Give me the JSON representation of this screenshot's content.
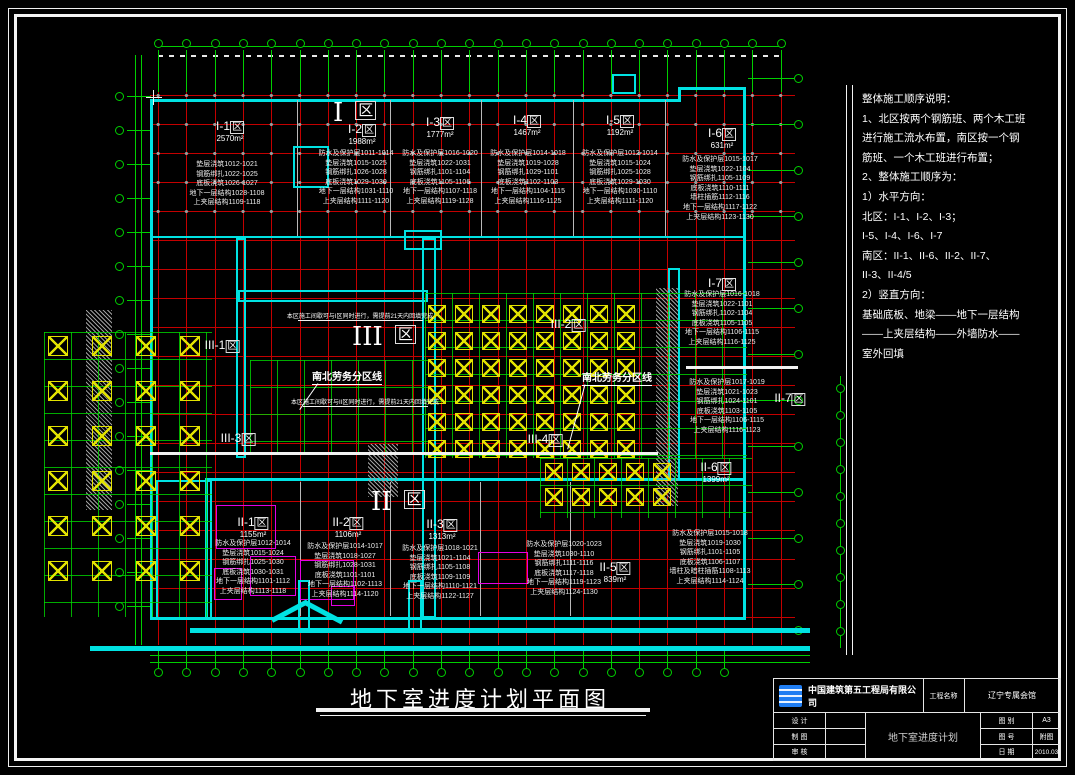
{
  "title": {
    "text": "地下室进度计划平面图"
  },
  "notes": {
    "lines": [
      "整体施工顺序说明：",
      "1、北区按两个钢筋班、两个木工班",
      "进行施工流水布置，南区按一个钢",
      "筋班、一个木工班进行布置；",
      "2、整体施工顺序为：",
      "1）水平方向：",
      "北区：I-1、I-2、I-3；",
      "I-5、I-4、I-6、I-7",
      "南区：II-1、II-6、II-2、II-7、",
      "II-3、II-4/5",
      "2）竖直方向：",
      "基础底板、地梁——地下一层结构",
      "——上夹层结构——外墙防水——",
      "室外回填"
    ]
  },
  "plan": {
    "big_labels": [
      {
        "id": "I",
        "text": "I",
        "qu": "区"
      },
      {
        "id": "III",
        "text": "III",
        "qu": "区"
      },
      {
        "id": "II",
        "text": "II",
        "qu": "区"
      }
    ],
    "zones": [
      {
        "id": "I-1",
        "label": "I-1区",
        "area": "2570m²",
        "tasks": [
          "垫层浇筑1012-1021",
          "钢筋绑扎1022-1025",
          "底板浇筑1026-1027",
          "地下一层结构1028-1108",
          "上夹层结构1109-1118"
        ]
      },
      {
        "id": "I-2",
        "label": "I-2区",
        "area": "1988m²",
        "tasks": [
          "防水及保护层1011-1014",
          "垫层浇筑1015-1025",
          "钢筋绑扎1026-1028",
          "底板浇筑1029-1030",
          "地下一层结构1031-1110",
          "上夹层结构1111-1120"
        ]
      },
      {
        "id": "I-3",
        "label": "I-3区",
        "area": "1777m²",
        "tasks": [
          "防水及保护层1016-1020",
          "垫层浇筑1022-1031",
          "钢筋绑扎1101-1104",
          "底板浇筑1105-1106",
          "地下一层结构1107-1118",
          "上夹层结构1119-1128"
        ]
      },
      {
        "id": "I-4",
        "label": "I-4区",
        "area": "1467m²",
        "tasks": [
          "防水及保护层1014-1018",
          "垫层浇筑1019-1028",
          "钢筋绑扎1029-1101",
          "底板浇筑1102-1103",
          "地下一层结构1104-1115",
          "上夹层结构1116-1125"
        ]
      },
      {
        "id": "I-5",
        "label": "I-5区",
        "area": "1192m²",
        "tasks": [
          "防水及保护层1012-1014",
          "垫层浇筑1015-1024",
          "钢筋绑扎1025-1028",
          "底板浇筑1029-1030",
          "地下一层结构1030-1110",
          "上夹层结构1111-1120"
        ]
      },
      {
        "id": "I-6",
        "label": "I-6区",
        "area": "631m²",
        "tasks": [
          "防水及保护层1015-1017",
          "垫层浇筑1022-1104",
          "钢筋绑扎1105-1109",
          "底板浇筑1110-1111",
          "墙柱插筋1112-1116",
          "地下一层结构1117-1122",
          "上夹层结构1123-1130"
        ]
      },
      {
        "id": "I-7",
        "label": "I-7区",
        "area": "",
        "tasks": [
          "防水及保护层1016-1018",
          "垫层浇筑1022-1101",
          "钢筋绑扎1102-1104",
          "底板浇筑1105-1105",
          "地下一层结构1106-1115",
          "上夹层结构1116-1125"
        ]
      },
      {
        "id": "II-7",
        "label": "II-7区",
        "area": "",
        "tasks": [
          "防水及保护层1017-1019",
          "垫层浇筑1021-1023",
          "钢筋绑扎1024-1101",
          "底板浇筑1103-1105",
          "地下一层结构1106-1115",
          "上夹层结构1116-1123"
        ]
      },
      {
        "id": "II-1",
        "label": "II-1区",
        "area": "1155m²",
        "tasks": [
          "防水及保护层1012-1014",
          "垫层浇筑1015-1024",
          "钢筋绑扎1025-1030",
          "底板浇筑1030-1031",
          "地下一层结构1101-1112",
          "上夹层结构1113-1118"
        ]
      },
      {
        "id": "II-2",
        "label": "II-2区",
        "area": "1106m²",
        "tasks": [
          "防水及保护层1014-1017",
          "垫层浇筑1018-1027",
          "钢筋绑扎1028-1031",
          "底板浇筑1101-1101",
          "地下一层结构1102-1113",
          "上夹层结构1114-1120"
        ]
      },
      {
        "id": "II-3",
        "label": "II-3区",
        "area": "1313m²",
        "tasks": [
          "防水及保护层1018-1021",
          "垫层浇筑1021-1104",
          "钢筋绑扎1105-1108",
          "底板浇筑1109-1109",
          "地下一层结构1110-1121",
          "上夹层结构1122-1127"
        ]
      },
      {
        "id": "II-5",
        "label": "II-5区",
        "area": "839m²",
        "tasks": [
          "防水及保护层1020-1023",
          "垫层浇筑1030-1110",
          "钢筋绑扎1111-1116",
          "底板浇筑1117-1118",
          "地下一层结构1119-1123",
          "上夹层结构1124-1130"
        ]
      },
      {
        "id": "II-6",
        "label": "II-6区",
        "area": "1399m²",
        "tasks": [
          "防水及保护层1015-1018",
          "垫层浇筑1019-1030",
          "钢筋绑扎1101-1105",
          "底板浇筑1106-1107",
          "墙柱及暗柱插筋1108-1113",
          "上夹层结构1114-1124"
        ]
      },
      {
        "id": "III-1",
        "label": "III-1区",
        "area": "",
        "tasks": []
      },
      {
        "id": "III-2",
        "label": "III-2区",
        "area": "",
        "tasks": []
      },
      {
        "id": "III-3",
        "label": "III-3区",
        "area": "",
        "tasks": []
      },
      {
        "id": "III-4",
        "label": "III-4区",
        "area": "",
        "tasks": []
      }
    ],
    "dividers": [
      {
        "text": "南北劳务分区线"
      },
      {
        "text": "南北劳务分区线"
      }
    ],
    "annotations": [
      {
        "text": "本区施工间歇可与I区同时进行，需提前21天内回填完成"
      },
      {
        "text": "本区施工间歇可与II区同时进行，需提前21天内回填完成"
      }
    ]
  },
  "titleblock": {
    "company": "中国建筑第五工程局有限公司",
    "project_label": "工程名称",
    "project_name": "辽宁专属会馆",
    "drawing_name": "地下室进度计划",
    "rows_left": [
      {
        "label": "设  计"
      },
      {
        "label": "制  图"
      },
      {
        "label": "审  核"
      }
    ],
    "rows_right": [
      {
        "label": "图  别",
        "value": "A3"
      },
      {
        "label": "图  号",
        "value": "附图"
      },
      {
        "label": "日  期",
        "value": "2010.03"
      }
    ]
  },
  "colors": {
    "grid_red": "#c40000",
    "axis_green": "#00cf00",
    "outline_cyan": "#00e2e2",
    "column_yellow": "#e2e200",
    "detail_magenta": "#e400e4",
    "logo_blue": "#1f7df2",
    "background": "#000000"
  }
}
